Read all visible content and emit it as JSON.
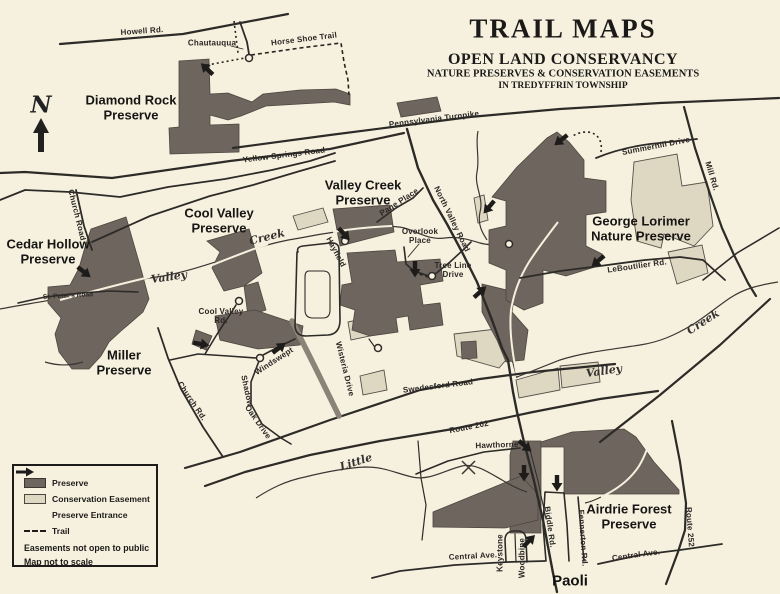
{
  "title": {
    "main": "TRAIL MAPS",
    "org": "OPEN LAND CONSERVANCY",
    "line1": "NATURE PRESERVES & CONSERVATION EASEMENTS",
    "line2": "IN TREDYFFRIN TOWNSHIP"
  },
  "compass": {
    "north": "N"
  },
  "preserves": {
    "diamond_rock": "Diamond Rock Preserve",
    "cedar_hollow": "Cedar Hollow Preserve",
    "miller": "Miller Preserve",
    "cool_valley": "Cool Valley Preserve",
    "valley_creek": "Valley Creek Preserve",
    "george_lorimer": "George Lorimer Nature Preserve",
    "airdrie_forest": "Airdrie Forest Preserve"
  },
  "roads": {
    "howell": "Howell Rd.",
    "chautauqua": "Chautauqua",
    "horse_shoe_trail": "Horse Shoe Trail",
    "pennsylvania_turnpike": "Pennsylvania Turnpike",
    "yellow_springs": "Yellow Springs Road",
    "summerhill": "Summerhill Drive",
    "mill": "Mill Rd.",
    "page_place": "Page Place",
    "north_valley": "North Valley Road",
    "overlook_place": "Overlook Place",
    "tree_line_drive": "Tree Line Drive",
    "hayfield": "Hayfield",
    "leboutilier": "LeBoutilier Rd.",
    "cool_valley_rd": "Cool Valley Rd.",
    "church_road": "Church Road",
    "st_peters": "St. Peter's Road",
    "church_rd": "Church Rd.",
    "shadow": "Shadow",
    "windswept": "Windswept",
    "oak_drive": "Oak Drive",
    "wisteria": "Wisteria Drive",
    "swedesford": "Swedesford Road",
    "route_202": "Route 202",
    "hawthorne": "Hawthorne",
    "central_ave_left": "Central Ave.",
    "central_ave_right": "Central Ave.",
    "route_252": "Route 252",
    "biddle": "Biddle Rd.",
    "fennerton": "Fennerton Rd.",
    "keystone": "Keystone",
    "woodbine": "Woodbine"
  },
  "waterways": {
    "valley_west": "Valley",
    "creek_west": "Creek",
    "valley_east": "Valley",
    "creek_east": "Creek",
    "little": "Little"
  },
  "places": {
    "paoli": "Paoli"
  },
  "legend": {
    "items": [
      {
        "key": "preserve",
        "label": "Preserve"
      },
      {
        "key": "easement",
        "label": "Conservation Easement"
      },
      {
        "key": "entrance",
        "label": "Preserve Entrance"
      },
      {
        "key": "trail",
        "label": "Trail"
      }
    ],
    "notes": [
      "Easements not open to public",
      "Map not to scale"
    ]
  },
  "colors": {
    "preserve": "#6e655e",
    "easement": "#ded7c1",
    "paper": "#f6f1df",
    "ink": "#2d2b28"
  }
}
